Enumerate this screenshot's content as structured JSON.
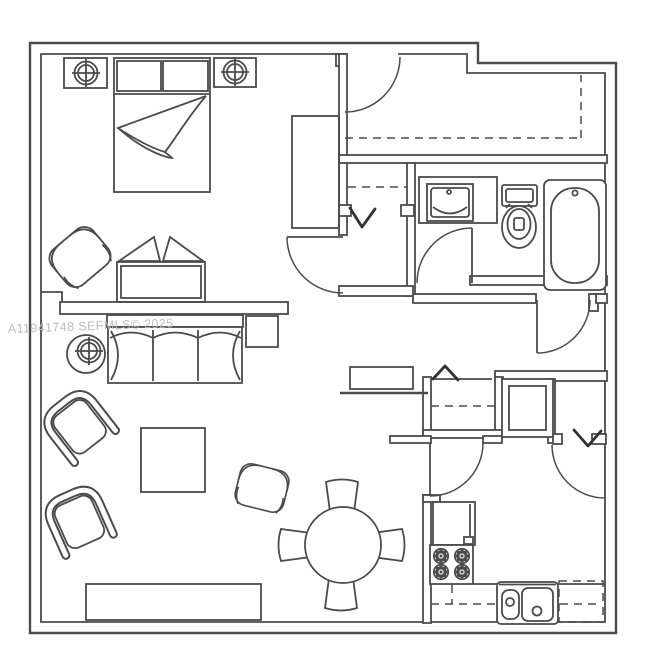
{
  "image": {
    "type": "floor-plan",
    "width": 650,
    "height": 658
  },
  "watermark": {
    "text": "A11941748 SEFMLS© 2025"
  },
  "colors": {
    "background": "#ffffff",
    "line": "#4b4b4b",
    "line_strong": "#333333",
    "watermark": "#bdbdbd",
    "fill": "#ffffff"
  }
}
